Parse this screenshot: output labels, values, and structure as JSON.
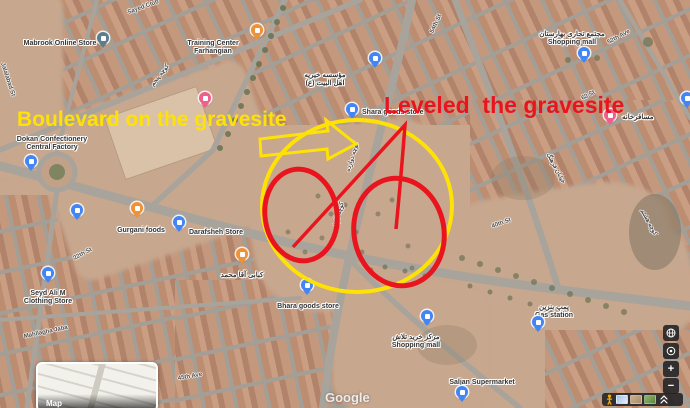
{
  "annotations": {
    "boulevard_label": "Boulevard on the gravesite",
    "leveled_label": "Leveled  the gravesite",
    "yellow": "#ffe205",
    "red": "#e9141d"
  },
  "watermark": "Google",
  "map_button": {
    "label": "Map"
  },
  "controls": {
    "zoom_in_label": "+",
    "zoom_out_label": "−"
  },
  "palette": {
    "pin_blue": "#4285f4",
    "pin_orange": "#ef9234",
    "pin_pink": "#ee5f8b",
    "pin_teal": "#5d7d8d",
    "road": "#a8a49c",
    "dirt": "#c7a78e"
  },
  "map": {
    "pins": [
      {
        "name": "mabrook-online-store",
        "x": 103,
        "y": 52,
        "color": "teal",
        "icon": "shopping-bag"
      },
      {
        "name": "restaurant-north",
        "x": 257,
        "y": 44,
        "color": "orange",
        "icon": "restaurant"
      },
      {
        "name": "hotel-training-center",
        "x": 205,
        "y": 112,
        "color": "pink",
        "icon": "hotel"
      },
      {
        "name": "institute",
        "x": 375,
        "y": 72,
        "color": "blue",
        "icon": "lock"
      },
      {
        "name": "shara-goods-store",
        "x": 352,
        "y": 123,
        "color": "blue",
        "icon": "shopping-bag"
      },
      {
        "name": "dokan-confectionery",
        "x": 31,
        "y": 175,
        "color": "blue",
        "icon": "shopping-bag"
      },
      {
        "name": "shop-west",
        "x": 77,
        "y": 224,
        "color": "blue",
        "icon": "shopping-bag"
      },
      {
        "name": "gurgani-foods",
        "x": 137,
        "y": 222,
        "color": "orange",
        "icon": "restaurant"
      },
      {
        "name": "darafsheh-store",
        "x": 179,
        "y": 236,
        "color": "blue",
        "icon": "shopping-bag"
      },
      {
        "name": "kebab-shop",
        "x": 242,
        "y": 268,
        "color": "orange",
        "icon": "restaurant"
      },
      {
        "name": "seyd-ali-clothing",
        "x": 48,
        "y": 287,
        "color": "blue",
        "icon": "shopping-bag"
      },
      {
        "name": "bhara-goods-store",
        "x": 307,
        "y": 299,
        "color": "blue",
        "icon": "shopping-bag"
      },
      {
        "name": "elbassam-mall",
        "x": 584,
        "y": 67,
        "color": "blue",
        "icon": "shopping-bag"
      },
      {
        "name": "guesthouse-east",
        "x": 610,
        "y": 129,
        "color": "pink",
        "icon": "hotel"
      },
      {
        "name": "shop-east-edge",
        "x": 687,
        "y": 112,
        "color": "blue",
        "icon": "shopping-bag"
      },
      {
        "name": "talash-mall",
        "x": 427,
        "y": 330,
        "color": "blue",
        "icon": "shopping-bag"
      },
      {
        "name": "gas-station",
        "x": 538,
        "y": 336,
        "color": "blue",
        "icon": "fuel"
      },
      {
        "name": "saljan-supermarket",
        "x": 462,
        "y": 406,
        "color": "blue",
        "icon": "shopping-bag"
      }
    ],
    "labels": [
      {
        "name": "mabrook-label",
        "x": 60,
        "y": 40,
        "lines": [
          "Mabrook Online Store"
        ]
      },
      {
        "name": "training-center-label",
        "x": 213,
        "y": 40,
        "lines": [
          "Training Center",
          "Farhangian"
        ]
      },
      {
        "name": "institute-label",
        "x": 325,
        "y": 72,
        "lines": [
          "مؤسسه خیریه",
          "اهل البیت (ع)"
        ]
      },
      {
        "name": "shara-goods-label",
        "x": 362,
        "y": 109,
        "align": "left",
        "lines": [
          "Shara goods store"
        ]
      },
      {
        "name": "dokan-label",
        "x": 52,
        "y": 136,
        "lines": [
          "Dokan Confectionery",
          "Central Factory"
        ]
      },
      {
        "name": "gurgani-label",
        "x": 141,
        "y": 227,
        "lines": [
          "Gurgani foods"
        ]
      },
      {
        "name": "darafsheh-label",
        "x": 216,
        "y": 229,
        "lines": [
          "Darafsheh Store"
        ]
      },
      {
        "name": "kebab-label",
        "x": 242,
        "y": 272,
        "lines": [
          "کبابی آقا محمد"
        ]
      },
      {
        "name": "seyd-ali-label",
        "x": 48,
        "y": 290,
        "lines": [
          "Seyd Ali M",
          "Clothing Store"
        ]
      },
      {
        "name": "bhara-label",
        "x": 308,
        "y": 303,
        "lines": [
          "Bhara goods store"
        ]
      },
      {
        "name": "elbassam-label",
        "x": 572,
        "y": 31,
        "lines": [
          "مجتمع تجاری بهارستان",
          "Shopping mall"
        ]
      },
      {
        "name": "guesthouse-label",
        "x": 622,
        "y": 114,
        "align": "left",
        "lines": [
          "مسافرخانه"
        ]
      },
      {
        "name": "talash-label",
        "x": 416,
        "y": 334,
        "lines": [
          "مرکز خرید تلاش",
          "Shopping mall"
        ]
      },
      {
        "name": "gas-station-label",
        "x": 554,
        "y": 304,
        "lines": [
          "پمپ بنزین",
          "Gas station"
        ]
      },
      {
        "name": "saljan-label",
        "x": 482,
        "y": 379,
        "lines": [
          "Saljan Supermarket"
        ]
      },
      {
        "name": "supermarkets-label",
        "x": 95,
        "y": 398,
        "lines": [
          "supermarkets"
        ]
      }
    ],
    "street_labels": [
      {
        "text": "Sayed Club",
        "x": 128,
        "y": 10,
        "rot": -20
      },
      {
        "text": "Jalalabad St",
        "x": 2,
        "y": 60,
        "rot": 72
      },
      {
        "text": "کوچه پنجم",
        "x": 152,
        "y": 82,
        "rot": -52
      },
      {
        "text": "54th St",
        "x": 432,
        "y": 30,
        "rot": -65
      },
      {
        "text": "52th Ave",
        "x": 608,
        "y": 40,
        "rot": -28
      },
      {
        "text": "62 St",
        "x": 582,
        "y": 96,
        "rot": -28
      },
      {
        "text": "خیابان فرهنگ",
        "x": 548,
        "y": 150,
        "rot": 62
      },
      {
        "text": "کوچه هشتم",
        "x": 642,
        "y": 206,
        "rot": 62
      },
      {
        "text": "22th St",
        "x": 74,
        "y": 256,
        "rot": -28
      },
      {
        "text": "Mahllagha Jaba",
        "x": 24,
        "y": 334,
        "rot": -12
      },
      {
        "text": "کوچه دوازده",
        "x": 348,
        "y": 168,
        "rot": -73
      },
      {
        "text": "کوچه گلها",
        "x": 336,
        "y": 222,
        "rot": -75
      },
      {
        "text": "45th Ave",
        "x": 178,
        "y": 376,
        "rot": -10
      },
      {
        "text": "40th St",
        "x": 492,
        "y": 224,
        "rot": -20
      }
    ]
  }
}
